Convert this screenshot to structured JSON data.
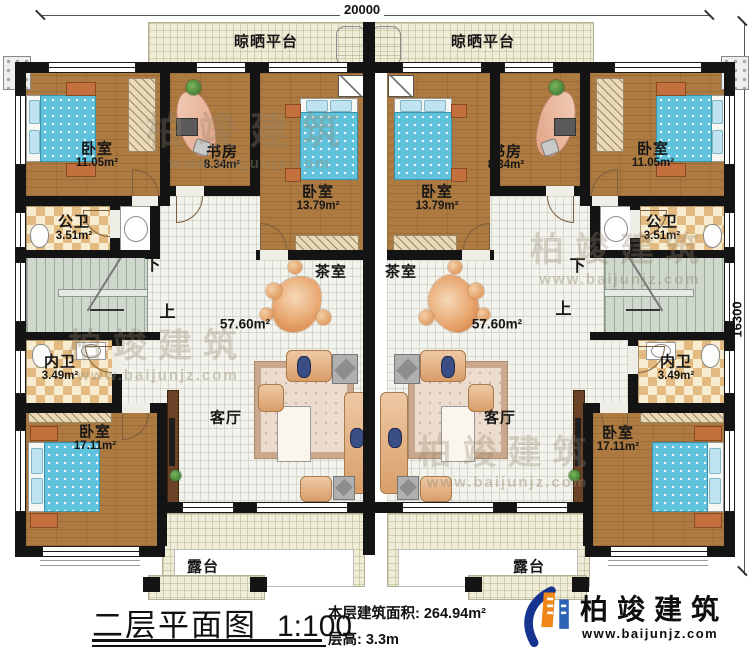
{
  "dimensions": {
    "top": "20000",
    "right": "16300"
  },
  "stairs": {
    "down": "下",
    "up": "上"
  },
  "rooms": {
    "platform": {
      "label": "晾晒平台"
    },
    "bedroom_11": {
      "label": "卧室",
      "area": "11.05m²"
    },
    "study": {
      "label": "书房",
      "area": "8.34m²"
    },
    "bedroom_13": {
      "label": "卧室",
      "area": "13.79m²"
    },
    "public_bath": {
      "label": "公卫",
      "area": "3.51m²"
    },
    "inner_bath": {
      "label": "内卫",
      "area": "3.49m²"
    },
    "tea_room": {
      "label": "茶室"
    },
    "hall_area": {
      "area": "57.60m²"
    },
    "living": {
      "label": "客厅"
    },
    "bedroom_17": {
      "label": "卧室",
      "area": "17.11m²"
    },
    "terrace": {
      "label": "露台"
    }
  },
  "titleblock": {
    "title": "二层平面图",
    "scale": "1:100",
    "building_area": "本层建筑面积: 264.94m²",
    "floor_height": "层高: 3.3m"
  },
  "brand": {
    "name": "柏竣建筑",
    "url": "www.baijunjz.com"
  },
  "watermark": {
    "name": "柏竣建筑",
    "url": "www.baijunjz.com"
  }
}
